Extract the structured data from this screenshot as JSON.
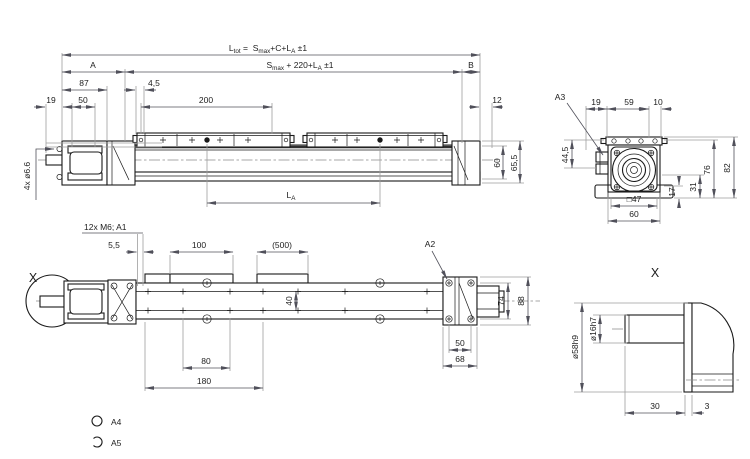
{
  "views": {
    "side_view": {
      "formula_ltot": {
        "base1": "L",
        "sub1": "tot",
        "base2": " =  S",
        "sub2": "max",
        "base3": "+C+L",
        "sub3": "A",
        "base4": " ±1"
      },
      "formula_smax": {
        "base1": "S",
        "sub1": "max",
        "base2": " + 220+L",
        "sub2": "A",
        "base3": " ±1"
      },
      "dim_a": "A",
      "dim_b": "B",
      "dim_87": "87",
      "dim_4_5": "4,5",
      "dim_19": "19",
      "dim_50": "50",
      "dim_200": "200",
      "dim_12": "12",
      "dim_60": "60",
      "dim_65_5": "65,5",
      "label_la": {
        "base": "L",
        "sub": "A"
      },
      "label_holes": "4x ø6.6"
    },
    "end_view": {
      "label_a3": "A3",
      "dim_19": "19",
      "dim_59": "59",
      "dim_10": "10",
      "dim_44_5": "44,5",
      "dim_76": "76",
      "dim_82": "82",
      "dim_31": "31",
      "dim_17": "17",
      "dim_sq47": "□47",
      "dim_60": "60"
    },
    "bottom_view": {
      "label_x": "X",
      "label_thread": "12x M6; A1",
      "dim_5_5": "5,5",
      "dim_100": "100",
      "dim_500": "(500)",
      "label_a2": "A2",
      "dim_40": "40",
      "dim_80": "80",
      "dim_180": "180",
      "dim_50": "50",
      "dim_68": "68",
      "dim_74": "74",
      "dim_88": "88"
    },
    "detail_view": {
      "label_x": "X",
      "dim_d58": "ø58h9",
      "dim_d16": "ø16h7",
      "dim_30": "30",
      "dim_3": "3"
    },
    "legend": {
      "item_a4": "A4",
      "item_a5": "A5"
    }
  }
}
